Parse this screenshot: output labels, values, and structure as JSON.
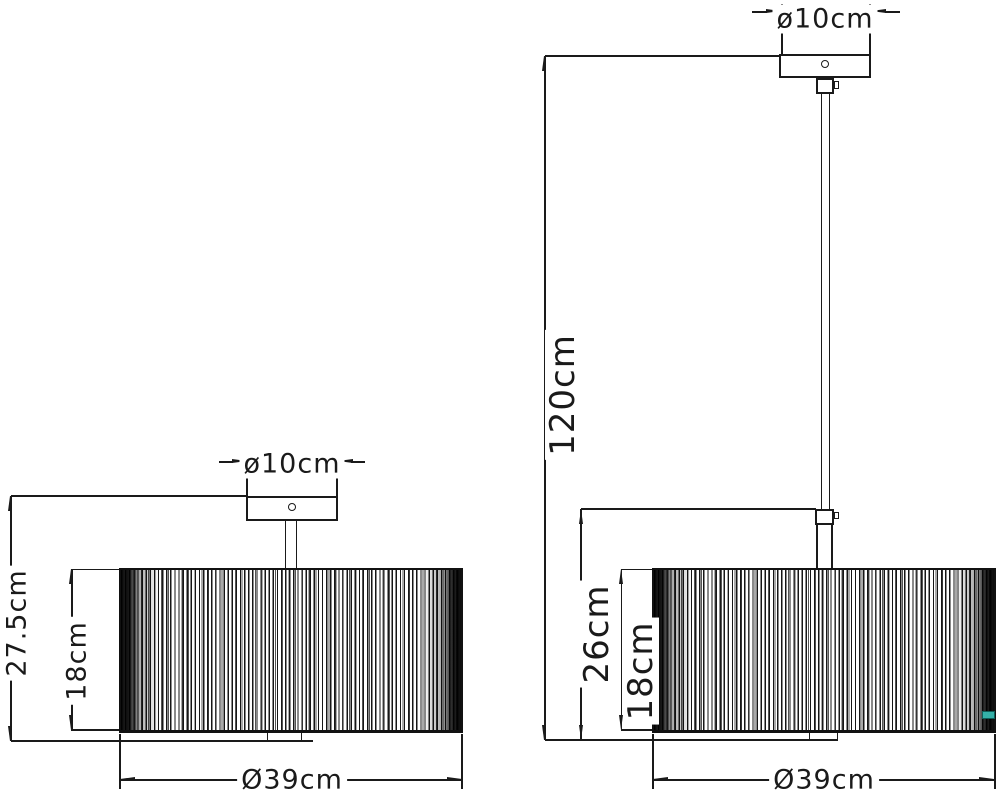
{
  "diagram": {
    "background_color": "#ffffff",
    "line_color": "#1a1a1a",
    "watermark_chip_color": "#35b0a8",
    "left_fixture": {
      "canopy_diameter": "ø10cm",
      "overall_height": "27.5cm",
      "shade_height": "18cm",
      "shade_diameter": "Ø39cm"
    },
    "right_fixture": {
      "canopy_diameter": "ø10cm",
      "overall_height": "120cm",
      "lower_section_height": "26cm",
      "shade_height": "18cm",
      "shade_diameter": "Ø39cm"
    }
  }
}
